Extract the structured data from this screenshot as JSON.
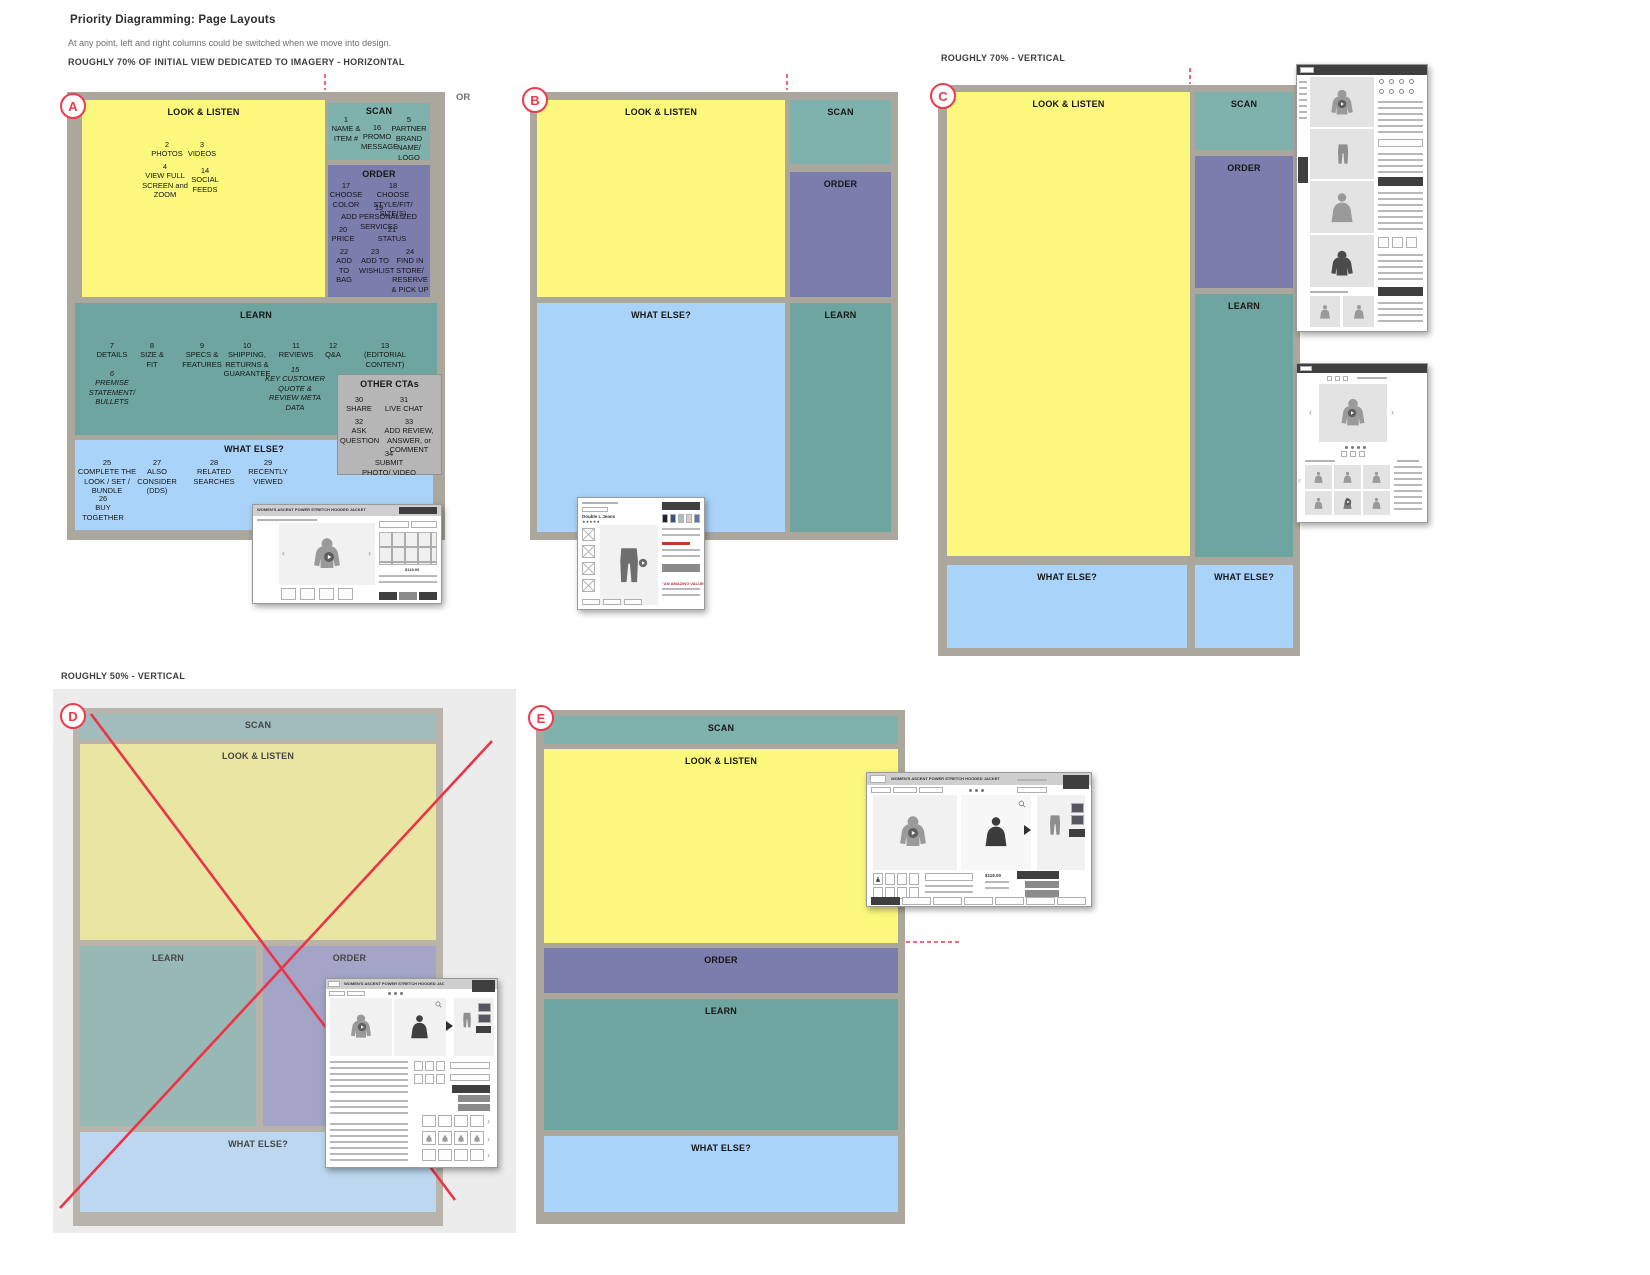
{
  "page": {
    "title": "Priority Diagramming: Page Layouts",
    "subtitle": "At any point, left and right columns could be switched when we move into design.",
    "sec1": "ROUGHLY 70% OF INITIAL VIEW DEDICATED TO IMAGERY - HORIZONTAL",
    "sec2": "ROUGHLY 70%  - VERTICAL",
    "sec3": "ROUGHLY 50%  - VERTICAL",
    "or": "OR"
  },
  "blocks": {
    "look": "LOOK & LISTEN",
    "scan": "SCAN",
    "order": "ORDER",
    "learn": "LEARN",
    "what_else": "WHAT ELSE?",
    "other_ctas": "OTHER CTAs"
  },
  "layouts": {
    "a": "A",
    "b": "B",
    "c": "C",
    "d": "D",
    "e": "E"
  },
  "A": {
    "look": [
      {
        "n": "2",
        "t": "PHOTOS"
      },
      {
        "n": "3",
        "t": "VIDEOS"
      },
      {
        "n": "4",
        "t": "VIEW FULL SCREEN and ZOOM"
      },
      {
        "n": "14",
        "t": "SOCIAL FEEDS"
      }
    ],
    "scan": [
      {
        "n": "1",
        "t": "NAME & ITEM #"
      },
      {
        "n": "16",
        "t": "PROMO MESSAGE"
      },
      {
        "n": "5",
        "t": "PARTNER BRAND NAME/ LOGO"
      }
    ],
    "order": [
      {
        "n": "17",
        "t": "CHOOSE COLOR"
      },
      {
        "n": "18",
        "t": "CHOOSE STYLE/FIT/ SIZE(S)"
      },
      {
        "n": "19",
        "t": "ADD PERSONALIZED SERVICES"
      },
      {
        "n": "20",
        "t": "PRICE"
      },
      {
        "n": "21",
        "t": "STATUS"
      },
      {
        "n": "22",
        "t": "ADD TO BAG"
      },
      {
        "n": "23",
        "t": "ADD TO WISHLIST"
      },
      {
        "n": "24",
        "t": "FIND IN STORE/ RESERVE & PICK UP"
      }
    ],
    "learn": [
      {
        "n": "7",
        "t": "DETAILS"
      },
      {
        "n": "8",
        "t": "SIZE & FIT"
      },
      {
        "n": "9",
        "t": "SPECS & FEATURES"
      },
      {
        "n": "10",
        "t": "SHIPPING, RETURNS & GUARANTEE"
      },
      {
        "n": "11",
        "t": "REVIEWS"
      },
      {
        "n": "12",
        "t": "Q&A"
      },
      {
        "n": "13",
        "t": "(EDITORIAL CONTENT)"
      }
    ],
    "learn2": [
      {
        "n": "6",
        "t": "PREMISE STATEMENT/ BULLETS"
      },
      {
        "n": "15",
        "t": "KEY CUSTOMER QUOTE & REVIEW META DATA"
      }
    ],
    "what": [
      {
        "n": "25",
        "t": "COMPLETE THE LOOK / SET / BUNDLE"
      },
      {
        "n": "27",
        "t": "ALSO CONSIDER (DDS)"
      },
      {
        "n": "28",
        "t": "RELATED SEARCHES"
      },
      {
        "n": "29",
        "t": "RECENTLY VIEWED"
      },
      {
        "n": "26",
        "t": "BUY TOGETHER"
      }
    ],
    "ctas": [
      {
        "n": "30",
        "t": "SHARE"
      },
      {
        "n": "31",
        "t": "LIVE CHAT"
      },
      {
        "n": "32",
        "t": "ASK QUESTION"
      },
      {
        "n": "33",
        "t": "ADD REVIEW, ANSWER, or COMMENT"
      },
      {
        "n": "34",
        "t": "SUBMIT PHOTO/ VIDEO"
      }
    ]
  },
  "thumbs": {
    "desktop_title": "WOMEN'S ASCENT POWER STRETCH HOODED JACKET",
    "price": "$119.00",
    "jeans_title": "Double L Jeans",
    "jeans_stars": "★★★★★",
    "jeans_note": "\"AN AMAZING VALUE\""
  },
  "colors": {
    "yellow": "#fbf87d",
    "scan_teal": "#7fb1ad",
    "learn_teal": "#6fa5a0",
    "order_purple": "#7b7dac",
    "what_blue": "#a9d3f8",
    "frame_gray": "#aba79c",
    "cta_gray": "#b6b6b6",
    "accent_red": "#ee3a4d"
  }
}
